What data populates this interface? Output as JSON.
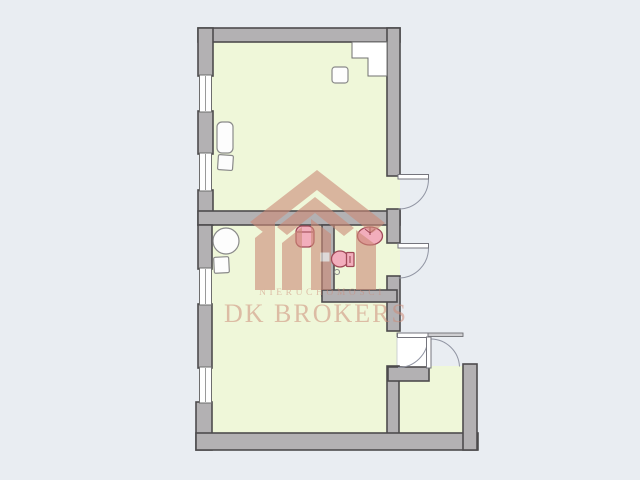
{
  "watermark": {
    "tagline": "NIERUCHOMOŚCI",
    "brand": "DK BROKERS"
  },
  "palette": {
    "background": "#e9edf2",
    "wall": "#b3b1b3",
    "wall_outline": "#4d4b4d",
    "floor": "#eff7d9",
    "white": "#ffffff",
    "fixture": "#f2aebc",
    "fixture_outline": "#a04a58",
    "door_arc": "#9195a3",
    "watermark": "#cc8a77"
  },
  "floorplan": {
    "rooms": [
      {
        "id": "room-upper"
      },
      {
        "id": "room-lower"
      },
      {
        "id": "bathroom"
      },
      {
        "id": "small-room"
      },
      {
        "id": "porch"
      }
    ],
    "window_count": 4,
    "exterior_door_count": 4,
    "fixtures": [
      "washbasin",
      "bathroom-sink",
      "toilet",
      "floor-drain"
    ],
    "furniture": [
      "sofa",
      "stool",
      "round-table",
      "stool",
      "cabinet",
      "side-table"
    ]
  }
}
